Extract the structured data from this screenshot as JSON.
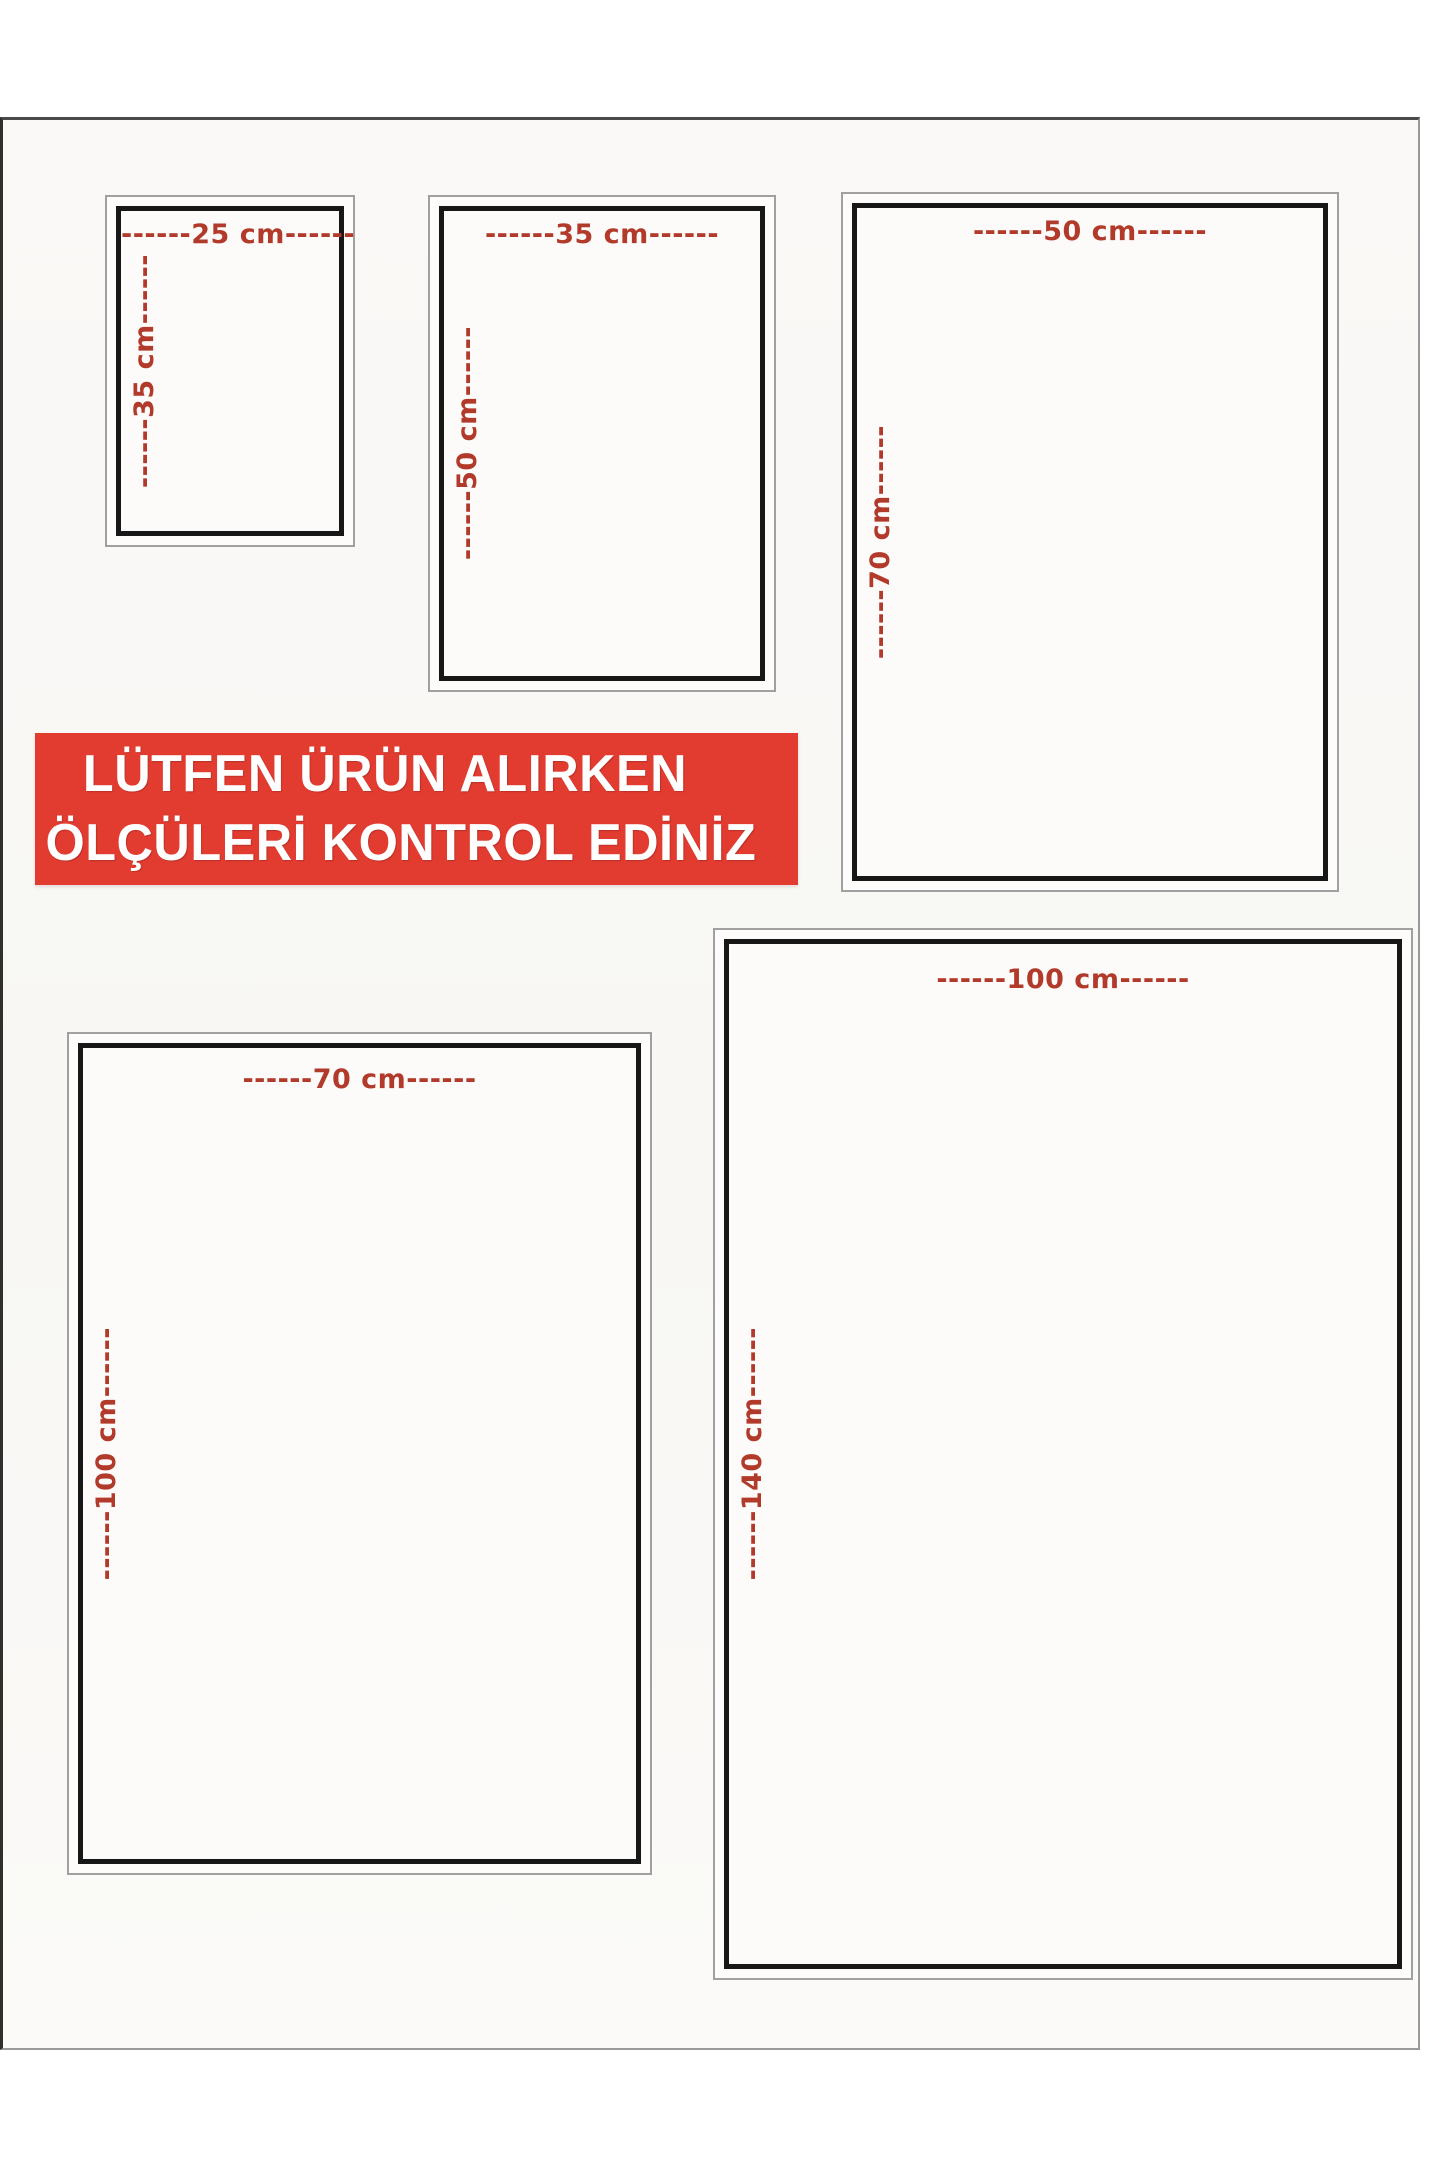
{
  "banner": {
    "line1": "LÜTFEN ÜRÜN ALIRKEN",
    "line2": "ÖLÇÜLERİ KONTROL EDİNİZ",
    "background": "#e23b30",
    "text_color": "#ffffff"
  },
  "colors": {
    "dimension_label": "#b23a2b",
    "box_border": "#171717",
    "frame_border": "#a0a0a0",
    "page_background": "#faf9f7"
  },
  "sizes": [
    {
      "name": "25x35 cm",
      "width_cm": 25,
      "height_cm": 35,
      "width_label": "------25 cm------",
      "height_label": "------35 cm------"
    },
    {
      "name": "35x50 cm",
      "width_cm": 35,
      "height_cm": 50,
      "width_label": "------35 cm------",
      "height_label": "------50 cm------"
    },
    {
      "name": "50x70 cm",
      "width_cm": 50,
      "height_cm": 70,
      "width_label": "------50 cm------",
      "height_label": "------70 cm------"
    },
    {
      "name": "70x100 cm",
      "width_cm": 70,
      "height_cm": 100,
      "width_label": "------70 cm------",
      "height_label": "------100 cm------"
    },
    {
      "name": "100x140 cm",
      "width_cm": 100,
      "height_cm": 140,
      "width_label": "------100 cm------",
      "height_label": "------140 cm------"
    }
  ]
}
